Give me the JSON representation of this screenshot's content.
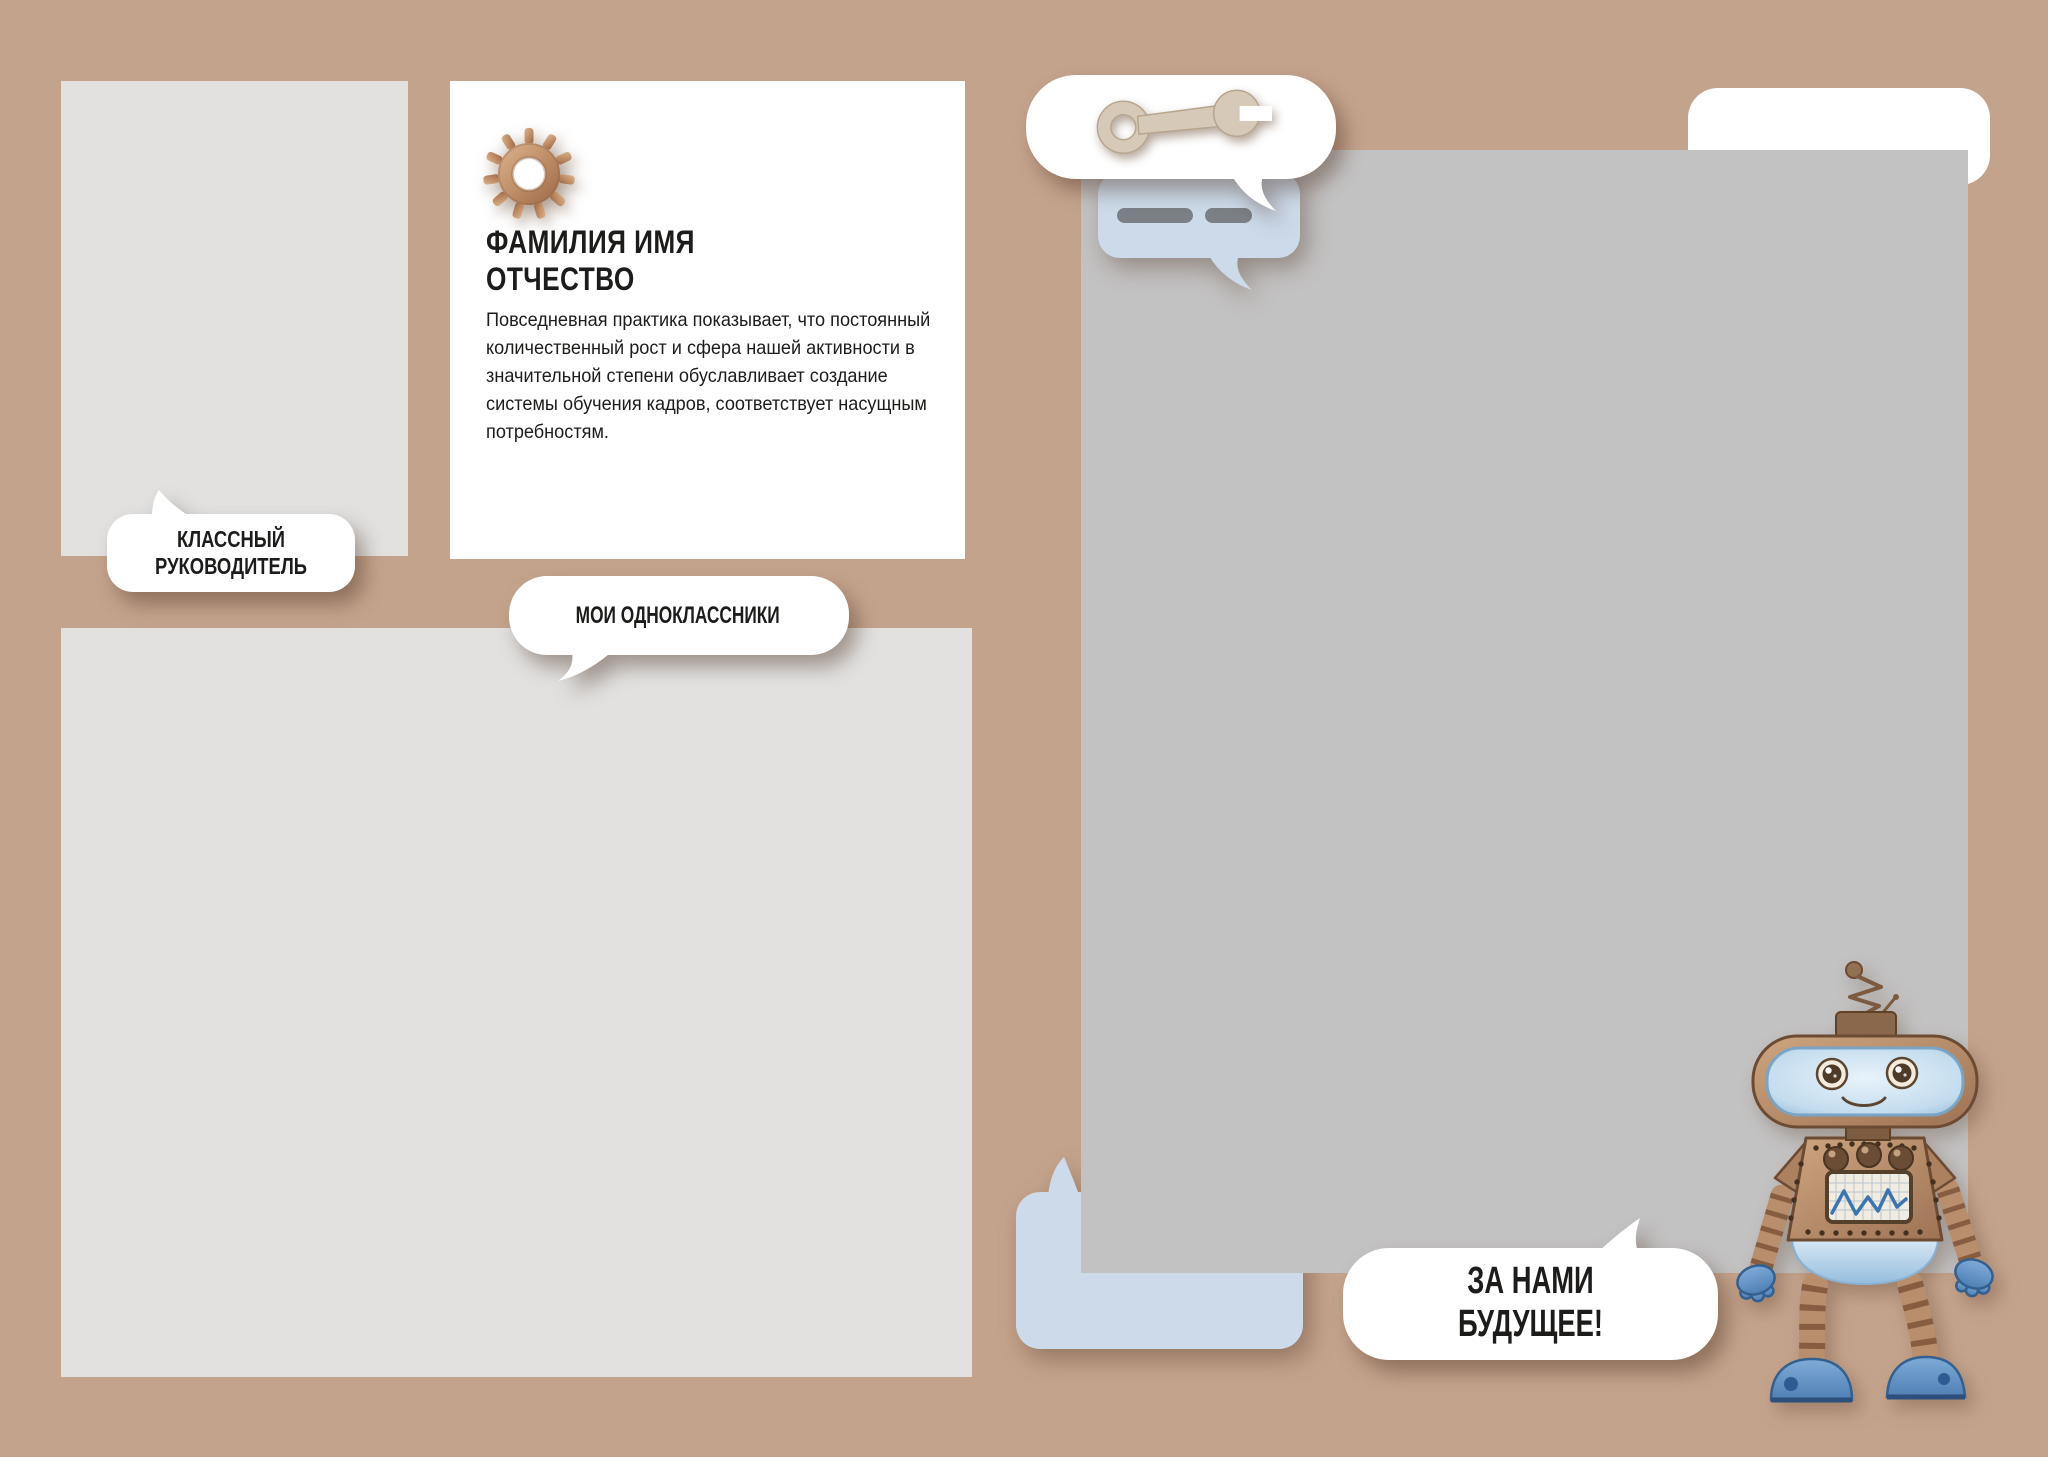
{
  "page": {
    "width": 2048,
    "height": 1457,
    "background": "#c4a38c"
  },
  "colors": {
    "background": "#c4a38c",
    "card_white": "#ffffff",
    "placeholder_light_gray": "#e2e1e0",
    "placeholder_mid_gray": "#c3c2c2",
    "bubble_blue": "#ccdaea",
    "chat_dash_gray": "#7b8087",
    "text_dark": "#1d1c1a",
    "copper_gear": "#bd8a64",
    "robot_blue": "#6094c8",
    "robot_brown": "#b08260"
  },
  "profile_card": {
    "title": "ФАМИЛИЯ ИМЯ ОТЧЕСТВО",
    "body": "Повседневная практика показывает, что постоянный количественный рост и сфера нашей активности в значительной степени обуславливает создание системы обучения кадров, соответствует насущным потребностям."
  },
  "bubbles": {
    "teacher": {
      "label": "КЛАССНЫЙ РУКОВОДИТЕЛЬ"
    },
    "classmates": {
      "label": "МОИ ОДНОКЛАССНИКИ"
    },
    "future": {
      "label": "ЗА НАМИ БУДУЩЕЕ!"
    }
  },
  "icons": {
    "gear": "gear-icon",
    "wrench": "wrench-icon",
    "chat_dashes": "chat-lines-icon",
    "robot": "robot-illustration"
  }
}
